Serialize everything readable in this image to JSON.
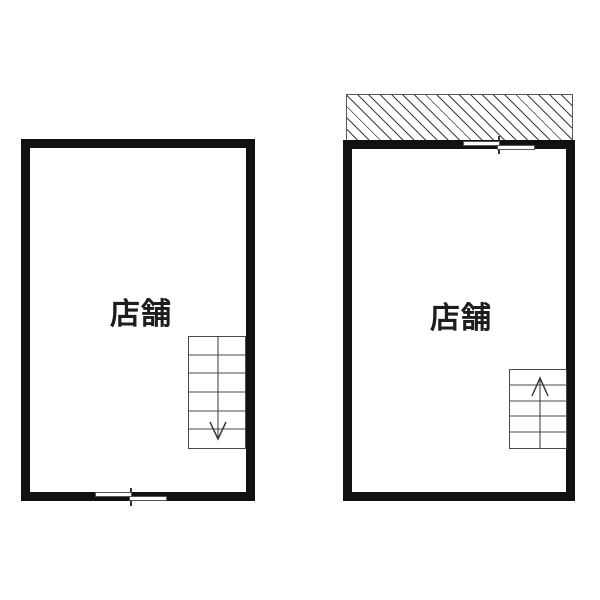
{
  "rooms": [
    {
      "id": "left",
      "label": "店舗",
      "stair_direction": "down"
    },
    {
      "id": "right",
      "label": "店舗",
      "stair_direction": "up"
    }
  ],
  "colors": {
    "wall": "#111111",
    "thin_line": "#4a4a4a",
    "hatch_line": "#3d3d3d",
    "background": "#ffffff"
  }
}
